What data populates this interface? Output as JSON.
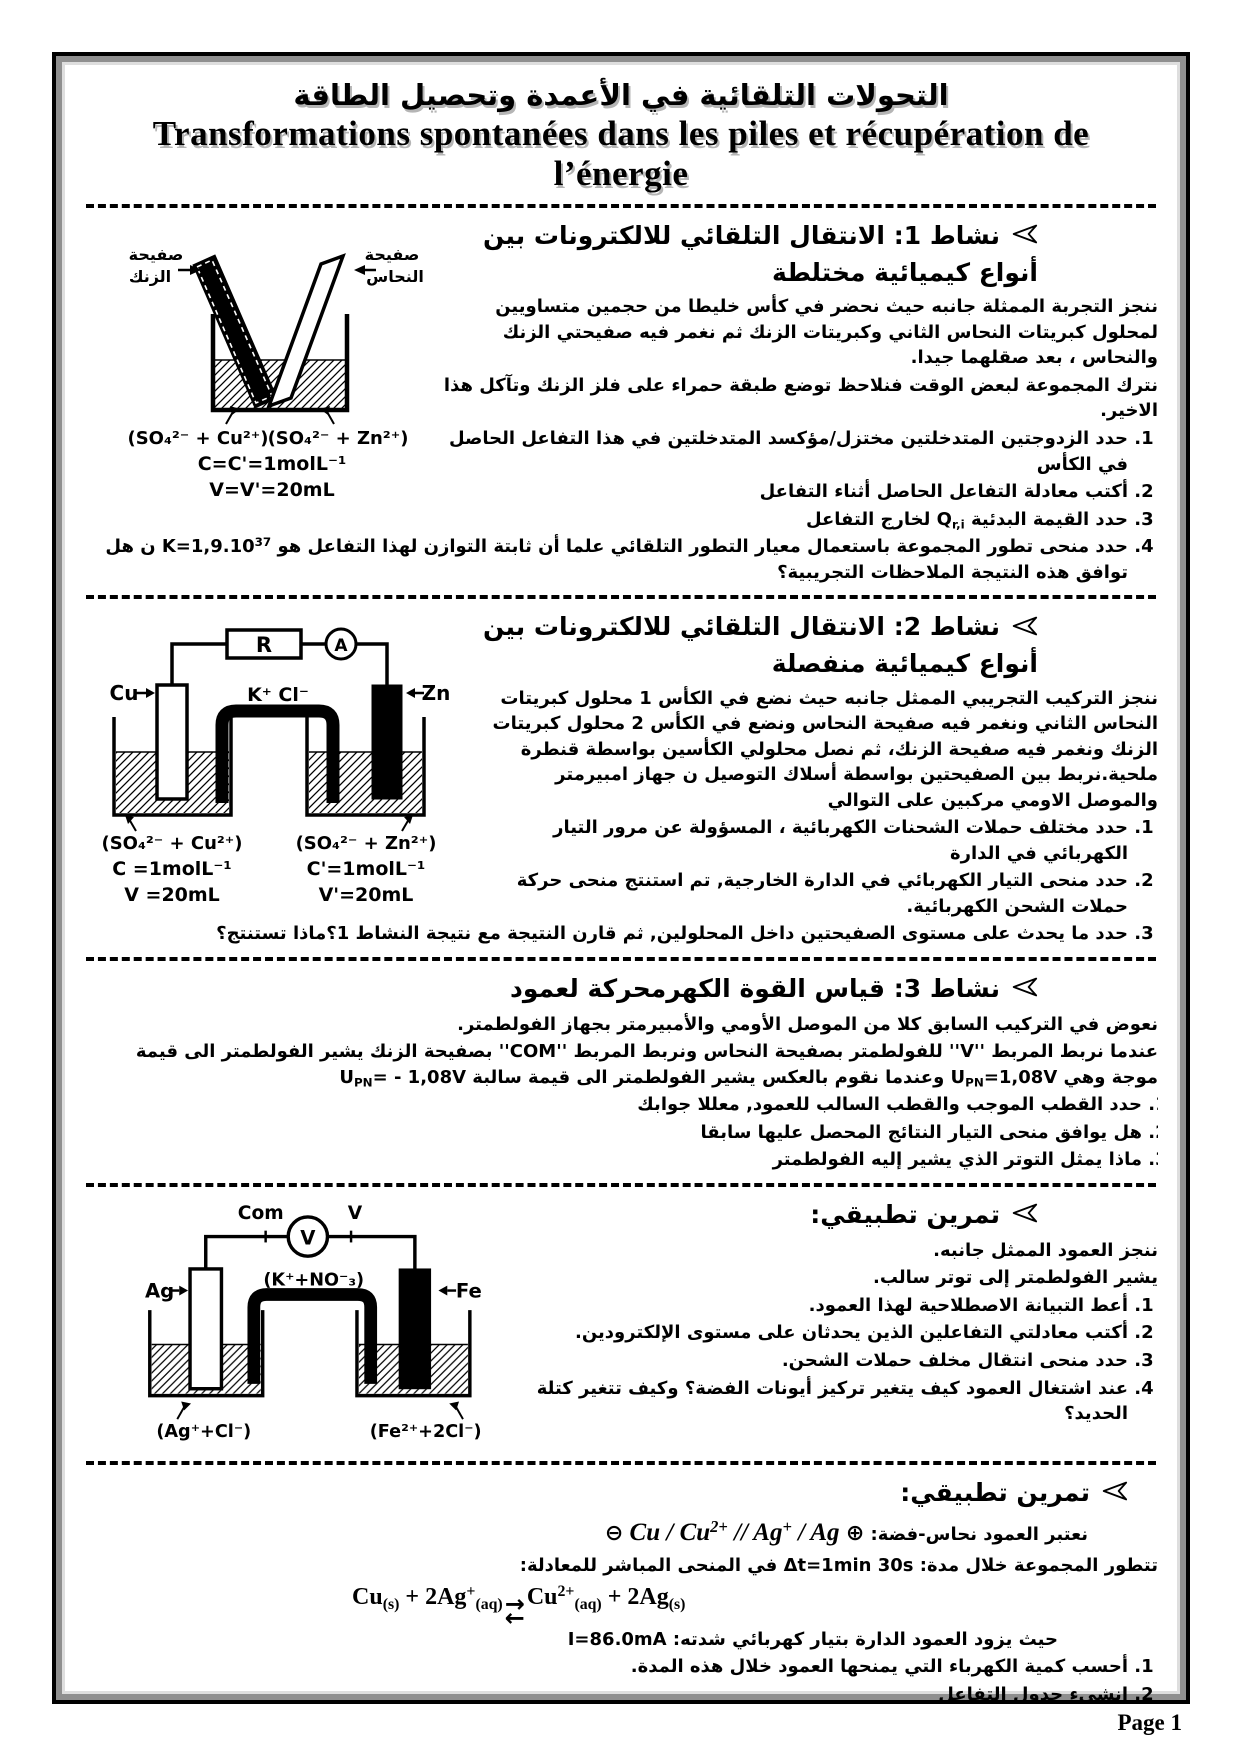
{
  "page": {
    "footer": "Page 1"
  },
  "title": {
    "arabic": "التحولات التلقائية في الأعمدة وتحصيل الطاقة",
    "french": "Transformations spontanées dans les piles et récupération de l’énergie"
  },
  "icons": {
    "eq_top": "→",
    "eq_bottom": "←",
    "pole_minus": "⊖",
    "pole_plus": "⊕"
  },
  "activity1": {
    "heading": "نشاط 1: الانتقال التلقائي للالكترونات بين أنواع كيميائية مختلطة",
    "para1": "ننجز التجربة الممثلة جانبه حيث نحضر في كأس خليطا من حجمين متساويين لمحلول كبريتات النحاس الثاني وكبريتات الزنك ثم نغمر فيه صفيحتي الزنك والنحاس ، بعد صقلهما جيدا.",
    "para2": "نترك المجموعة لبعض الوقت  فنلاحظ توضع طبقة حمراء على فلز الزنك وتآكل هذا الاخير.",
    "items": [
      "حدد الزدوجتين المتدخلتين مختزل/مؤكسد المتدخلتين في هذا التفاعل الحاصل في الكأس",
      "أكتب معادلة التفاعل الحاصل أثناء التفاعل",
      "حدد القيمة البدئية Q~r,i~ لخارج التفاعل",
      "حدد منحى تطور المجموعة باستعمال معيار التطور التلقائي علما أن ثابتة التوازن لهذا التفاعل هو K=1,9.10^37^ ن هل توافق هذه النتيجة الملاحظات التجريبية؟"
    ],
    "diagram": {
      "plate_left_1": "صفيحة",
      "plate_left_2": "الزنك",
      "plate_right_1": "صفيحة",
      "plate_right_2": "النحاس",
      "sol_left": "(SO₄²⁻ + Cu²⁺)",
      "sol_right": "(SO₄²⁻ + Zn²⁺)",
      "conc": "C=C'=1molL⁻¹",
      "vol": "V=V'=20mL"
    }
  },
  "activity2": {
    "heading": "نشاط 2: الانتقال التلقائي للالكترونات بين أنواع كيميائية منفصلة",
    "para1": "ننجز التركيب التجريبي الممثل جانبه حيث نضع في الكأس 1  محلول كبريتات النحاس الثاني ونغمر فيه صفيحة النحاس ونضع في الكأس 2  محلول كبريتات الزنك ونغمر فيه صفيحة الزنك، ثم نصل محلولي الكأسين بواسطة قنطرة ملحية.نربط بين الصفيحتين بواسطة أسلاك التوصيل ن جهاز امبيرمتر والموصل الاومي مركبين على التوالي",
    "items": [
      "حدد مختلف حملات الشحنات الكهربائية ، المسؤولة عن مرور التيار الكهربائي في الدارة",
      "حدد منحى التيار الكهربائي في الدارة الخارجية, تم استنتج منحى حركة حملات الشحن الكهربائية.",
      "حدد ما يحدث على مستوى الصفيحتين داخل المحلولين, ثم قارن النتيجة مع نتيجة النشاط 1؟ماذا تستنتج؟"
    ],
    "diagram": {
      "resistor": "R",
      "ammeter": "A",
      "electrode_left": "Cu",
      "electrode_right": "Zn",
      "bridge": "K⁺  Cl⁻",
      "sol_left": "(SO₄²⁻ + Cu²⁺)",
      "conc_left": "C =1molL⁻¹",
      "vol_left": "V =20mL",
      "sol_right": "(SO₄²⁻ + Zn²⁺)",
      "conc_right": "C'=1molL⁻¹",
      "vol_right": "V'=20mL"
    }
  },
  "activity3": {
    "heading": "نشاط 3: قياس القوة الكهرمحركة لعمود",
    "para1": "نعوض في التركيب السابق كلا من الموصل الأومي والأمبيرمتر بجهاز الفولطمتر.",
    "para2": "عندما نربط المربط ''V'' للفولطمتر بصفيحة النحاس ونربط المربط ''COM'' بصفيحة الزنك يشير الفولطمتر الى قيمة موجة وهي U~PN~=1,08V وعندما نقوم بالعكس يشير الفولطمتر الى قيمة سالبة U~PN~= - 1,08V",
    "items": [
      "حدد القطب الموجب والقطب السالب للعمود, معللا جوابك",
      "هل يوافق منحى التيار النتائج المحصل عليها سابقا",
      "ماذا يمثل التوتر الذي يشير إليه الفولطمتر"
    ]
  },
  "exercise1": {
    "heading": "تمرين تطبيقي:",
    "para1": "ننجز العمود الممثل جانبه.",
    "para2": "يشير الفولطمتر إلى توتر سالب.",
    "items": [
      "أعط التبيانة الاصطلاحية لهذا العمود.",
      "أكتب معادلتي التفاعلين الذين يحدثان على مستوى الإلكترودين.",
      "حدد منحى انتقال مخلف حملات الشحن.",
      "عند اشتغال العمود كيف يتغير تركيز أيونات الفضة؟ وكيف تتغير كتلة الحديد؟"
    ],
    "diagram": {
      "voltmeter": "V",
      "terminal_com": "Com",
      "terminal_v": "V",
      "electrode_left": "Ag",
      "electrode_right": "Fe",
      "bridge": "(K⁺+NO⁻₃)",
      "sol_left": "(Ag⁺+Cl⁻)",
      "sol_right": "(Fe²⁺+2Cl⁻)"
    }
  },
  "exercise2": {
    "heading": "تمرين تطبيقي:",
    "intro": "نعتبر العمود نحاس-فضة:",
    "notation": "Cu / Cu^2+^ // Ag^+^ / Ag",
    "duration": "تتطور المجموعة خلال مدة: Δt=1min 30s في المنحى المباشر للمعادلة:",
    "equation_left": "Cu~(s)~ + 2Ag^+^~(aq)~",
    "equation_right": "Cu^2+^~(aq)~ + 2Ag~(s)~",
    "current": "حيث يزود العمود الدارة بتيار كهربائي شدته: I=86.0mA",
    "items": [
      "أحسب كمية الكهرباء التي يمنحها العمود خلال هذه المدة.",
      "انشىء جدول التفاعل",
      "حدد تقدم التفاعل الموافق لهذة التفاعل",
      "أحسب تغير كمية مادة Ag^+^~(aq)~ و Cu^2+^~(aq)~ خلال نفس المدة السابقة.",
      "استنتج تغير كتلة الفضة التي ستظهر على إلكترود الفضة."
    ]
  }
}
